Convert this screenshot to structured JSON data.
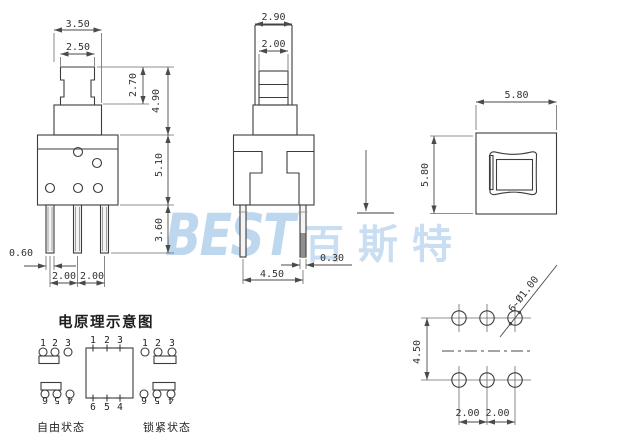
{
  "drawing": {
    "front_view": {
      "width_top": "3.50",
      "width_cap": "2.50",
      "btn_height": "2.70",
      "height_above_base": "4.90",
      "body_height": "5.10",
      "pin_length": "3.60",
      "pin_width": "0.60",
      "pin_pitch_a": "2.00",
      "pin_pitch_b": "2.00"
    },
    "side_view": {
      "width_top": "2.90",
      "width_cap": "2.00",
      "pin_thickness": "0.30",
      "pin_span": "4.50"
    },
    "top_view": {
      "width": "5.80",
      "height": "5.80"
    },
    "pcb_view": {
      "row_pitch": "4.50",
      "col_pitch_a": "2.00",
      "col_pitch_b": "2.00",
      "hole_callout": "6-Ø1.00"
    }
  },
  "schematic": {
    "title": "电原理示意图",
    "free": {
      "label": "自由状态",
      "top": [
        "1",
        "2",
        "3"
      ],
      "bottom": [
        "6",
        "5",
        "4"
      ]
    },
    "center": {
      "top": [
        "1",
        "2",
        "3"
      ],
      "bottom": [
        "6",
        "5",
        "4"
      ]
    },
    "locked": {
      "label": "锁紧状态",
      "top": [
        "1",
        "2",
        "3"
      ],
      "bottom": [
        "6",
        "5",
        "4"
      ]
    }
  },
  "watermark": {
    "latin": "BEST",
    "cjk": "百斯特"
  },
  "colors": {
    "watermark_blue": "#bdd7ee",
    "line": "#3c3c3c"
  }
}
